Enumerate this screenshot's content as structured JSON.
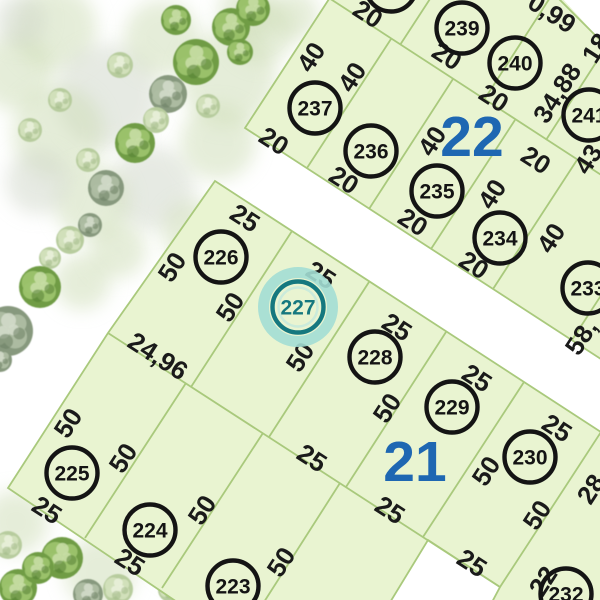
{
  "map": {
    "title": "cadastral-parcel-map",
    "colors": {
      "background": "#ffffff",
      "parcel_fill": "#e9f4d1",
      "parcel_line": "#a9c97c",
      "circle_stroke": "#141414",
      "label_color": "#1a1a1a",
      "block_number_color": "#1e67b2",
      "highlight_ring": "#15787f",
      "highlight_halo": "#a3ded4",
      "highlight_inner": "#c2e8dd"
    },
    "selected_parcel": "227",
    "blocks": [
      {
        "name": "block-22",
        "number": "22",
        "number_pos": [
          472,
          137
        ],
        "polygon": [
          [
            331,
            -4
          ],
          [
            245,
            128
          ],
          [
            604,
            361
          ],
          [
            604,
            -4
          ]
        ],
        "lines": [
          [
            329,
            -2,
            612,
            182
          ],
          [
            391,
            39,
            307,
            168
          ],
          [
            453,
            79,
            369,
            209
          ],
          [
            515,
            120,
            431,
            249
          ],
          [
            577,
            160,
            493,
            289
          ],
          [
            656,
            211,
            572,
            340
          ],
          [
            471,
            -64,
            400,
            45
          ],
          [
            555,
            -10,
            484,
            100
          ],
          [
            617,
            30,
            546,
            140
          ],
          [
            679,
            70,
            608,
            180
          ],
          [
            558,
            -2,
            602,
            42
          ]
        ],
        "parcels": [
          {
            "num": "238",
            "cx": 391,
            "cy": -14,
            "highlight": false
          },
          {
            "num": "239",
            "cx": 462,
            "cy": 28,
            "highlight": false
          },
          {
            "num": "240",
            "cx": 515,
            "cy": 63,
            "highlight": false
          },
          {
            "num": "241",
            "cx": 589,
            "cy": 115,
            "highlight": false
          },
          {
            "num": "237",
            "cx": 315,
            "cy": 108,
            "highlight": false
          },
          {
            "num": "236",
            "cx": 371,
            "cy": 151,
            "highlight": false
          },
          {
            "num": "235",
            "cx": 437,
            "cy": 191,
            "highlight": false
          },
          {
            "num": "234",
            "cx": 500,
            "cy": 238,
            "highlight": false
          },
          {
            "num": "233",
            "cx": 588,
            "cy": 288,
            "highlight": false
          }
        ],
        "dims": [
          {
            "t": "20",
            "x": 368,
            "y": 14,
            "r": 33
          },
          {
            "t": "0,99",
            "x": 552,
            "y": 13,
            "r": 33
          },
          {
            "t": "18",
            "x": 596,
            "y": 48,
            "r": -57
          },
          {
            "t": "20",
            "x": 447,
            "y": 56,
            "r": 33
          },
          {
            "t": "20",
            "x": 494,
            "y": 98,
            "r": 33
          },
          {
            "t": "20",
            "x": 536,
            "y": 160,
            "r": 33
          },
          {
            "t": "20",
            "x": 274,
            "y": 141,
            "r": 33
          },
          {
            "t": "20",
            "x": 344,
            "y": 180,
            "r": 33
          },
          {
            "t": "20",
            "x": 413,
            "y": 222,
            "r": 33
          },
          {
            "t": "20",
            "x": 474,
            "y": 265,
            "r": 33
          },
          {
            "t": "40",
            "x": 311,
            "y": 57,
            "r": -57
          },
          {
            "t": "40",
            "x": 352,
            "y": 77,
            "r": -57
          },
          {
            "t": "40",
            "x": 432,
            "y": 141,
            "r": -57
          },
          {
            "t": "40",
            "x": 492,
            "y": 194,
            "r": -57
          },
          {
            "t": "40",
            "x": 551,
            "y": 238,
            "r": -57
          },
          {
            "t": "34,88",
            "x": 557,
            "y": 93,
            "r": -57
          },
          {
            "t": "43,",
            "x": 590,
            "y": 156,
            "r": -57
          },
          {
            "t": "58,",
            "x": 581,
            "y": 337,
            "r": -57
          }
        ]
      },
      {
        "name": "block-21",
        "number": "21",
        "number_pos": [
          415,
          462
        ],
        "polygon": [
          [
            215,
            181
          ],
          [
            604,
            434
          ],
          [
            604,
            604
          ],
          [
            491,
            604
          ],
          [
            500,
            587
          ],
          [
            428,
            540
          ],
          [
            389,
            604
          ],
          [
            180,
            604
          ],
          [
            8,
            488
          ],
          [
            108,
            333
          ]
        ],
        "lines": [
          [
            108,
            333,
            500,
            587
          ],
          [
            292,
            231,
            191,
            387
          ],
          [
            369,
            282,
            269,
            437
          ],
          [
            446,
            332,
            346,
            487
          ],
          [
            524,
            382,
            423,
            537
          ],
          [
            601,
            432,
            500,
            587
          ],
          [
            186,
            383,
            85,
            538
          ],
          [
            263,
            433,
            162,
            588
          ],
          [
            340,
            483,
            264,
            602
          ]
        ],
        "parcels": [
          {
            "num": "226",
            "cx": 221,
            "cy": 257,
            "highlight": false
          },
          {
            "num": "227",
            "cx": 298,
            "cy": 307,
            "highlight": true
          },
          {
            "num": "228",
            "cx": 375,
            "cy": 357,
            "highlight": false
          },
          {
            "num": "229",
            "cx": 452,
            "cy": 407,
            "highlight": false
          },
          {
            "num": "230",
            "cx": 530,
            "cy": 457,
            "highlight": false
          },
          {
            "num": "232",
            "cx": 566,
            "cy": 594,
            "highlight": false
          },
          {
            "num": "225",
            "cx": 72,
            "cy": 473,
            "highlight": false
          },
          {
            "num": "224",
            "cx": 150,
            "cy": 530,
            "highlight": false
          },
          {
            "num": "223",
            "cx": 233,
            "cy": 586,
            "highlight": false
          }
        ],
        "dims": [
          {
            "t": "25",
            "x": 245,
            "y": 218,
            "r": 33
          },
          {
            "t": "25",
            "x": 321,
            "y": 275,
            "r": 33
          },
          {
            "t": "25",
            "x": 397,
            "y": 327,
            "r": 33
          },
          {
            "t": "25",
            "x": 477,
            "y": 378,
            "r": 33
          },
          {
            "t": "25",
            "x": 557,
            "y": 428,
            "r": 33
          },
          {
            "t": "50",
            "x": 172,
            "y": 267,
            "r": -57
          },
          {
            "t": "50",
            "x": 230,
            "y": 307,
            "r": -57
          },
          {
            "t": "50",
            "x": 300,
            "y": 357,
            "r": -57
          },
          {
            "t": "50",
            "x": 387,
            "y": 408,
            "r": -57
          },
          {
            "t": "50",
            "x": 486,
            "y": 471,
            "r": -57
          },
          {
            "t": "50",
            "x": 537,
            "y": 515,
            "r": -57
          },
          {
            "t": "24,96",
            "x": 158,
            "y": 356,
            "r": 33
          },
          {
            "t": "25",
            "x": 312,
            "y": 458,
            "r": 33
          },
          {
            "t": "25",
            "x": 390,
            "y": 510,
            "r": 33
          },
          {
            "t": "25",
            "x": 472,
            "y": 563,
            "r": 33
          },
          {
            "t": "50",
            "x": 68,
            "y": 423,
            "r": -57
          },
          {
            "t": "50",
            "x": 123,
            "y": 458,
            "r": -57
          },
          {
            "t": "50",
            "x": 202,
            "y": 510,
            "r": -57
          },
          {
            "t": "50",
            "x": 281,
            "y": 562,
            "r": -57
          },
          {
            "t": "25",
            "x": 47,
            "y": 510,
            "r": 33
          },
          {
            "t": "25",
            "x": 130,
            "y": 562,
            "r": 33
          },
          {
            "t": "22",
            "x": 543,
            "y": 581,
            "r": -57
          },
          {
            "t": "28",
            "x": 591,
            "y": 489,
            "r": -57
          }
        ]
      }
    ],
    "white_overlays": [
      [
        [
          560,
          -4
        ],
        [
          604,
          -4
        ],
        [
          604,
          44
        ]
      ]
    ],
    "vegetation": {
      "washes": [
        [
          55,
          28,
          42,
          0
        ],
        [
          15,
          72,
          38,
          0
        ],
        [
          108,
          96,
          52,
          1
        ],
        [
          58,
          132,
          46,
          0
        ],
        [
          162,
          38,
          38,
          0
        ],
        [
          228,
          78,
          48,
          0
        ],
        [
          152,
          188,
          42,
          1
        ],
        [
          218,
          142,
          38,
          0
        ],
        [
          92,
          202,
          38,
          0
        ],
        [
          38,
          182,
          32,
          1
        ],
        [
          262,
          32,
          32,
          0
        ],
        [
          194,
          232,
          32,
          0
        ],
        [
          82,
          282,
          28,
          0
        ],
        [
          248,
          12,
          30,
          0
        ],
        [
          295,
          15,
          24,
          0
        ],
        [
          150,
          482,
          36,
          0
        ],
        [
          16,
          522,
          32,
          0
        ],
        [
          100,
          572,
          36,
          0
        ],
        [
          182,
          556,
          28,
          0
        ],
        [
          596,
          20,
          16,
          1
        ],
        [
          20,
          20,
          26,
          1
        ],
        [
          118,
          250,
          28,
          0
        ]
      ],
      "trees": [
        [
          196,
          62,
          23,
          0
        ],
        [
          231,
          27,
          19,
          0
        ],
        [
          176,
          20,
          15,
          0
        ],
        [
          253,
          9,
          17,
          0
        ],
        [
          240,
          52,
          13,
          0
        ],
        [
          168,
          94,
          19,
          1
        ],
        [
          135,
          143,
          20,
          0
        ],
        [
          106,
          188,
          18,
          1
        ],
        [
          120,
          65,
          13,
          2
        ],
        [
          60,
          100,
          12,
          2
        ],
        [
          30,
          130,
          12,
          2
        ],
        [
          156,
          120,
          13,
          2
        ],
        [
          88,
          160,
          12,
          2
        ],
        [
          208,
          106,
          12,
          2
        ],
        [
          70,
          240,
          14,
          2
        ],
        [
          90,
          225,
          12,
          1
        ],
        [
          50,
          258,
          11,
          2
        ],
        [
          40,
          287,
          21,
          0
        ],
        [
          8,
          331,
          25,
          1
        ],
        [
          0,
          360,
          12,
          1
        ],
        [
          62,
          558,
          21,
          0
        ],
        [
          18,
          588,
          19,
          0
        ],
        [
          38,
          568,
          16,
          0
        ],
        [
          88,
          594,
          15,
          1
        ],
        [
          8,
          545,
          14,
          2
        ],
        [
          140,
          560,
          12,
          2
        ],
        [
          118,
          589,
          15,
          2
        ],
        [
          170,
          590,
          12,
          2
        ],
        [
          215,
          596,
          13,
          0
        ],
        [
          593,
          8,
          12,
          1
        ]
      ]
    }
  }
}
